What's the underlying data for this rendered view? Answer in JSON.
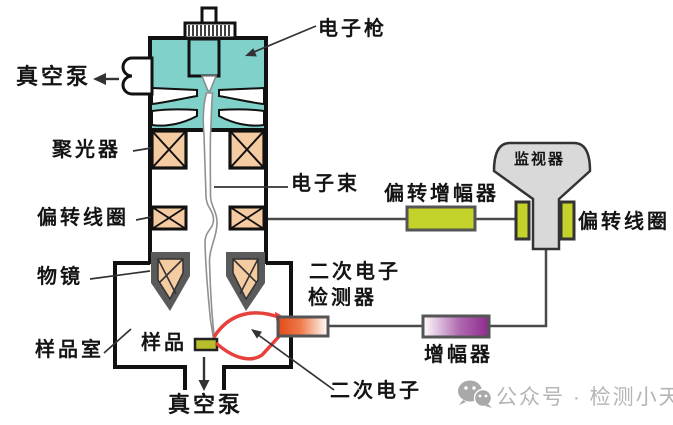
{
  "diagram": {
    "title_hint": "SEM scanning electron microscope schematic",
    "labels": {
      "electron_gun": "电子枪",
      "vacuum_pump_top": "真空泵",
      "condenser": "聚光器",
      "electron_beam": "电子束",
      "deflection_coil_left": "偏转线圈",
      "objective_lens": "物镜",
      "sample": "样品",
      "sample_chamber": "样品室",
      "vacuum_pump_bottom": "真空泵",
      "deflection_amplifier": "偏转增幅器",
      "monitor": "监视器",
      "deflection_coil_right": "偏转线圈",
      "se_detector_line1": "二次电子",
      "se_detector_line2": "检测器",
      "amplifier": "增幅器",
      "secondary_electrons": "二次电子"
    },
    "colors": {
      "gun_housing_teal": "#7fd1c9",
      "coil_fill_peach": "#f5cba1",
      "objective_gray": "#5a5a5a",
      "component_green": "#c3d32c",
      "monitor_gray": "#d9d9d9",
      "amplifier_purple": "#8e2a8e",
      "detector_orange": "#e24a18",
      "sample_olive": "#b9bd2a",
      "se_trajectory_red": "#e8403a",
      "wire": "#4a4a4a",
      "outline": "#111111"
    },
    "watermark": {
      "icon": "wechat-official-account-icon",
      "text": "公众号 · 检测小天地"
    }
  }
}
